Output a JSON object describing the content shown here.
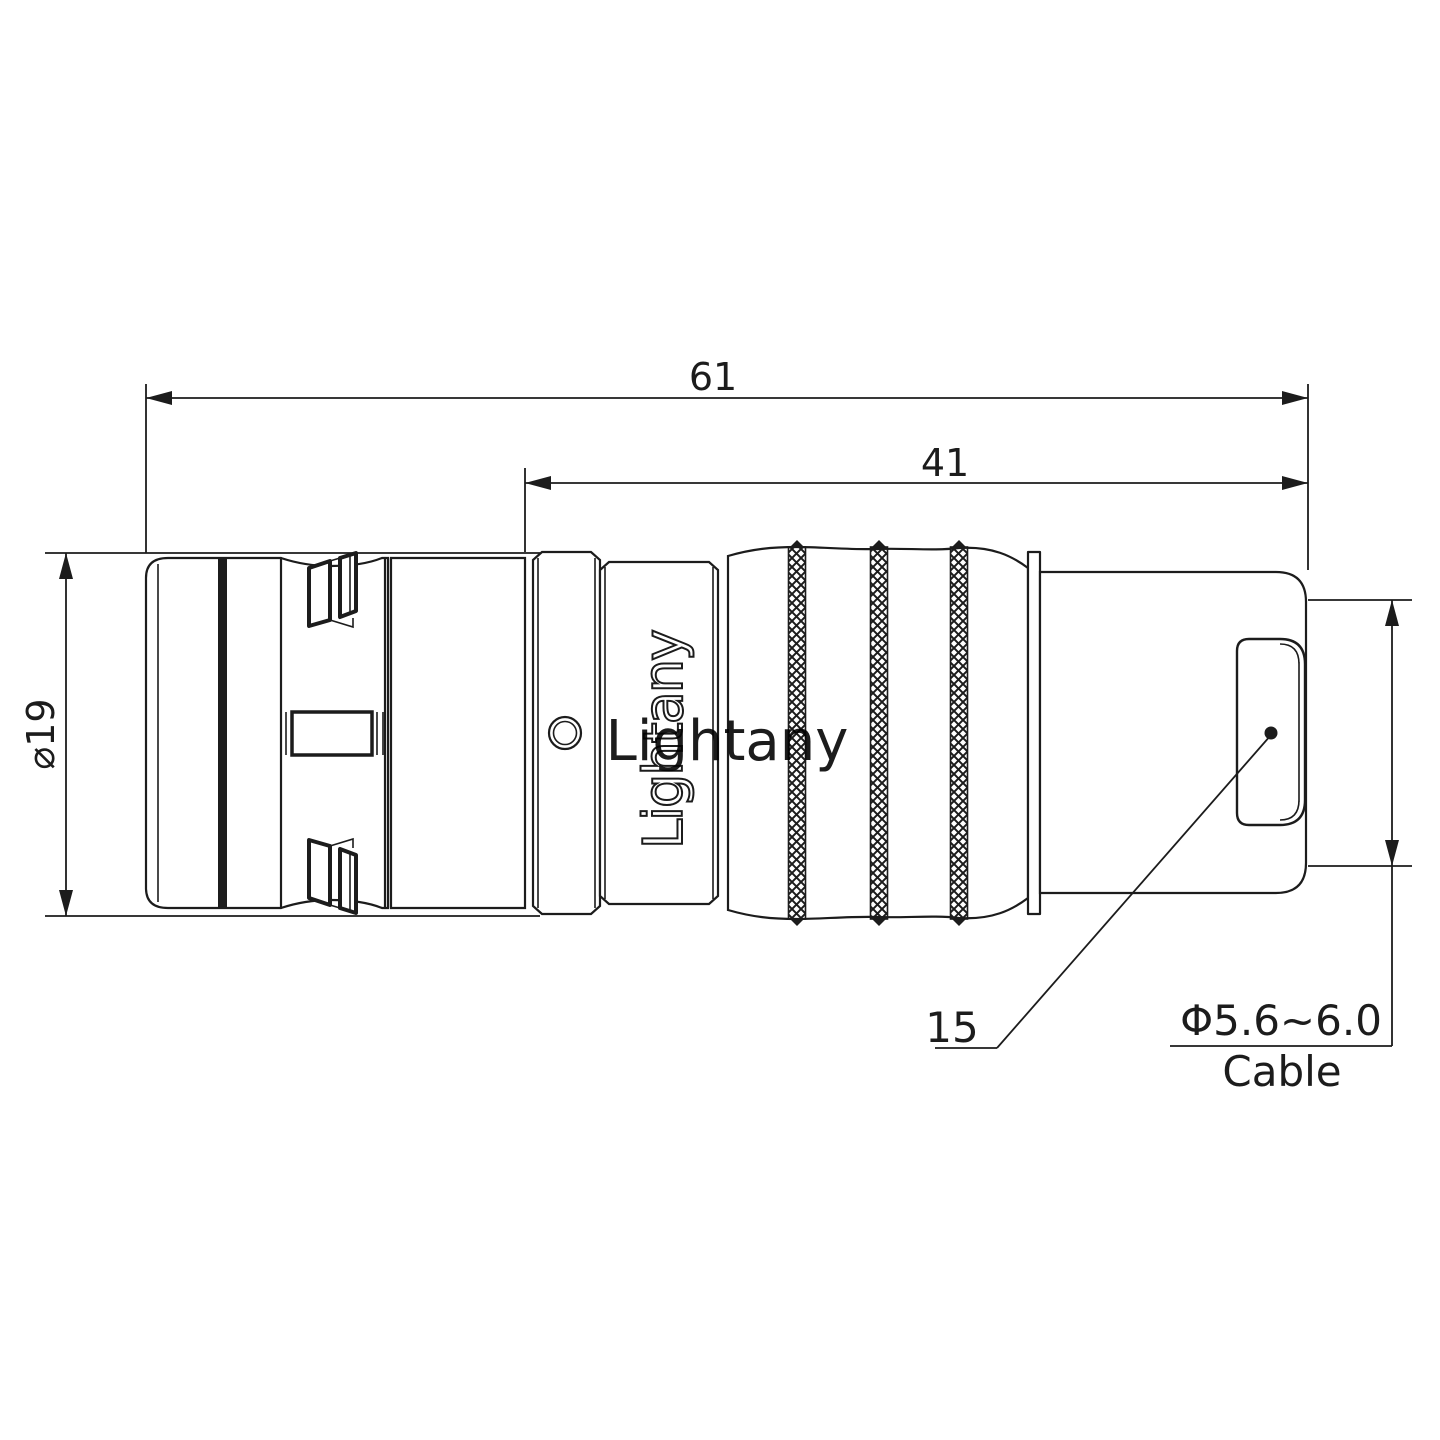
{
  "colors": {
    "line": "#1c1c1c",
    "watermark": "rgba(222,118,118,0.38)"
  },
  "dimensions": {
    "overall_length": "61",
    "body_length": "41",
    "shell_diameter": "⌀19",
    "cable_entry_ref": "15",
    "cable_diameter_range": "Φ5.6~6.0",
    "cable_word": "Cable"
  },
  "branding": {
    "engraving": "Lightany",
    "watermark": "Lightany"
  }
}
